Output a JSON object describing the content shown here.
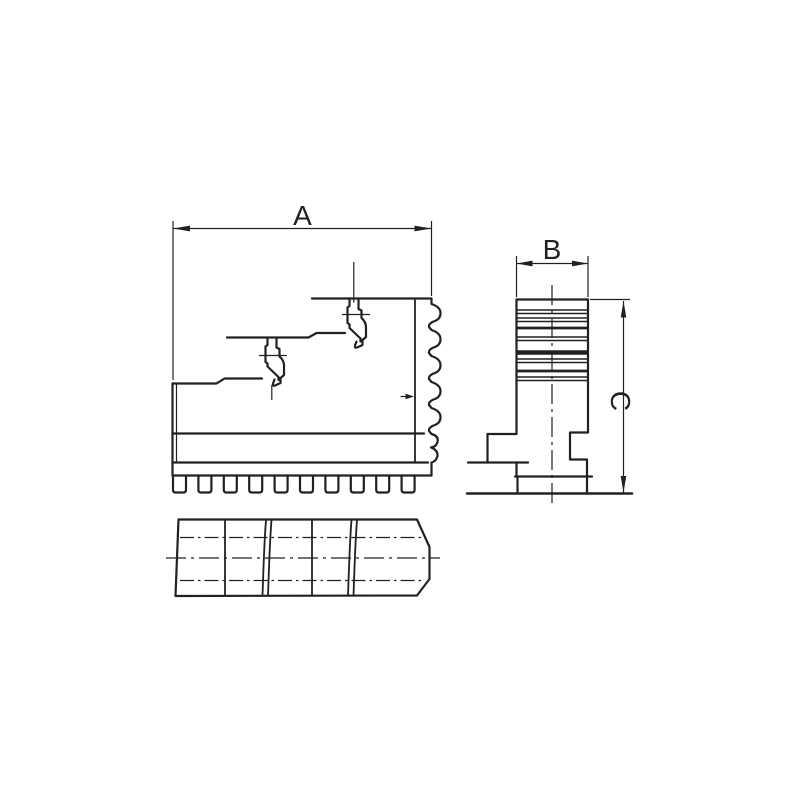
{
  "drawing": {
    "labels": {
      "width_a": "A",
      "width_b": "B",
      "height_c": "C"
    },
    "colors": {
      "ink": "#212121",
      "background": "#ffffff"
    },
    "icons": {
      "dimension_arrows": "arrowhead-icon",
      "serration_pointer": "arrowhead-icon"
    }
  }
}
